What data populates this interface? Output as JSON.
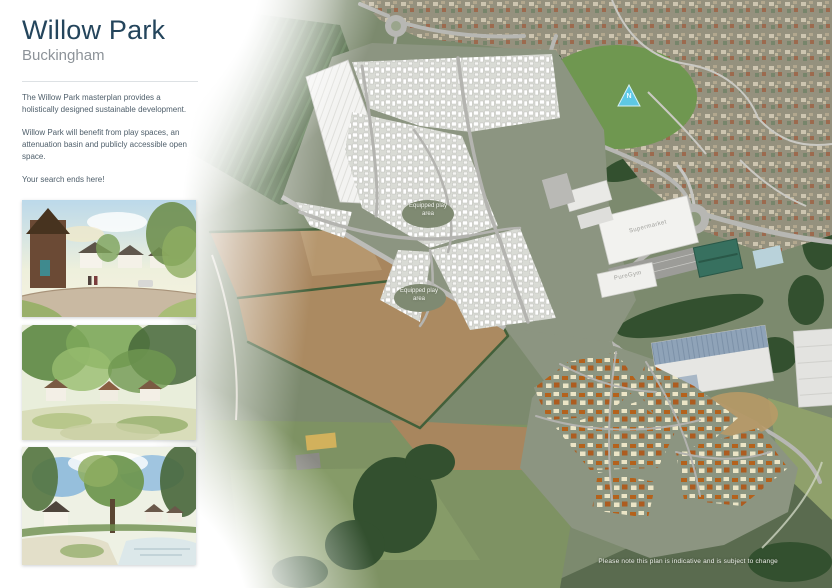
{
  "sidebar": {
    "title": "Willow Park",
    "subtitle": "Buckingham",
    "paragraph1": "The Willow Park masterplan provides a holistically designed sustainable development.",
    "paragraph2": "Willow Park will benefit from play spaces, an attenuation basin and publicly accessible open space.",
    "tagline": "Your search ends here!"
  },
  "map": {
    "labels": {
      "supermarket": "Supermarket",
      "gym": "PureGym",
      "play_areas": [
        "Equipped play area",
        "Equipped play area"
      ],
      "north": "N"
    },
    "disclaimer": "Please note this plan is indicative and is subject to change"
  },
  "colors": {
    "title_navy": "#24455c",
    "open_space_green": "#8c9581",
    "roof_orange": "#b4621c",
    "roof_cream": "#ece5c6",
    "field_brown": "#a8865e",
    "north_marker_cyan": "#5ec8e4"
  }
}
